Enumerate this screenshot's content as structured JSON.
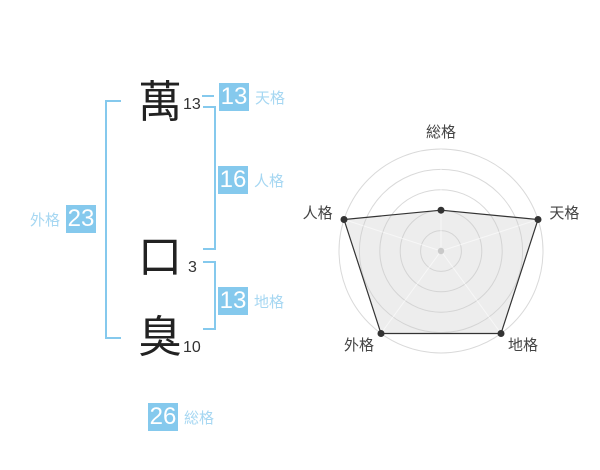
{
  "name_chart": {
    "characters": [
      {
        "glyph": "萬",
        "strokes": "13"
      },
      {
        "glyph": "口",
        "strokes": "3"
      },
      {
        "glyph": "臭",
        "strokes": "10"
      }
    ],
    "categories": {
      "tenkaku": {
        "value": "13",
        "label": "天格"
      },
      "jinkaku": {
        "value": "16",
        "label": "人格"
      },
      "chikaku": {
        "value": "13",
        "label": "地格"
      },
      "gaikaku": {
        "value": "23",
        "label": "外格"
      },
      "soukaku": {
        "value": "26",
        "label": "総格"
      }
    },
    "colors": {
      "accent": "#85c9ed",
      "category_label": "#a6d7f2",
      "text": "#333333"
    }
  },
  "chart_data": {
    "type": "radar",
    "categories": [
      "総格",
      "天格",
      "地格",
      "外格",
      "人格"
    ],
    "values": [
      2,
      5,
      5,
      5,
      5
    ],
    "max": 5,
    "rings": 5,
    "start_angle_deg": 90,
    "direction": "clockwise",
    "center": [
      441,
      251
    ],
    "radius": 102,
    "legend": false,
    "grid_color": "#d9d9d9",
    "spoke_color": "#ffffff",
    "line_color": "#333333",
    "point_color": "#333333",
    "fill_color": "#cccccc",
    "fill_opacity": 0.35,
    "center_dot_color": "#c9c9c9",
    "label_color": "#444444"
  }
}
